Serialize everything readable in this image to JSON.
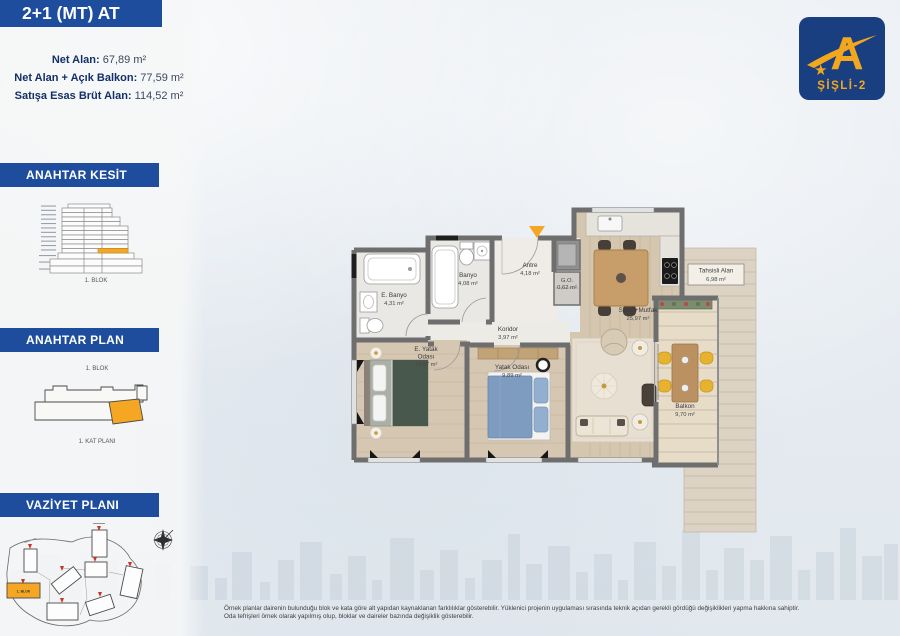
{
  "unit": {
    "type_label": "2+1 (MT) AT",
    "areas": [
      {
        "label": "Net Alan:",
        "value": "67,89 m²"
      },
      {
        "label": "Net Alan + Açık Balkon:",
        "value": "77,59 m²"
      },
      {
        "label": "Satışa Esas Brüt Alan:",
        "value": "114,52 m²"
      }
    ]
  },
  "sidebar": {
    "kesit": {
      "title": "ANAHTAR KESİT",
      "caption": "1. BLOK"
    },
    "plan": {
      "title": "ANAHTAR PLAN",
      "block_caption": "1. BLOK",
      "floor_caption": "1. KAT PLANI"
    },
    "vaziyet": {
      "title": "VAZİYET PLANI",
      "highlight_label": "1. BLOK"
    }
  },
  "logo": {
    "letter": "A",
    "project": "ŞİŞLİ-2"
  },
  "floorplan": {
    "rooms": {
      "e_banyo": {
        "name": "E. Banyo",
        "area": "4,31 m²"
      },
      "banyo": {
        "name": "Banyo",
        "area": "4,08 m²"
      },
      "antre": {
        "name": "Antre",
        "area": "4,18 m²"
      },
      "go": {
        "name": "G.O.",
        "area": "0,62 m²"
      },
      "koridor": {
        "name": "Koridor",
        "area": "3,97 m²"
      },
      "salon": {
        "name": "Salon+Mutfak",
        "area": "25,97 m²"
      },
      "e_yatak": {
        "name": "E. Yatak",
        "name2": "Odası",
        "area": "14,87 m²"
      },
      "yatak": {
        "name": "Yatak Odası",
        "area": "9,89 m²"
      },
      "balkon": {
        "name": "Balkon",
        "area": "9,70 m²"
      },
      "tahsisli": {
        "name": "Tahsisli Alan",
        "area": "6,98 m²"
      }
    }
  },
  "disclaimer": {
    "line1": "Örnek planlar dairenin bulunduğu blok ve kata göre alt yapıdan kaynaklanan farklılıklar gösterebilir. Yüklenici projenin uygulaması sırasında teknik açıdan gerekli gördüğü değişiklikleri yapma hakkına sahiptir.",
    "line2": "Oda tefrişleri örnek olarak yapılmış olup, bloklar ve daireler bazında değişiklik gösterebilir."
  },
  "colors": {
    "band_blue": "#1d4d9c",
    "highlight_orange": "#f5a623",
    "logo_navy": "#1a3f80",
    "logo_orange": "#f2a71f",
    "wall_gray": "#6e6e6e"
  }
}
